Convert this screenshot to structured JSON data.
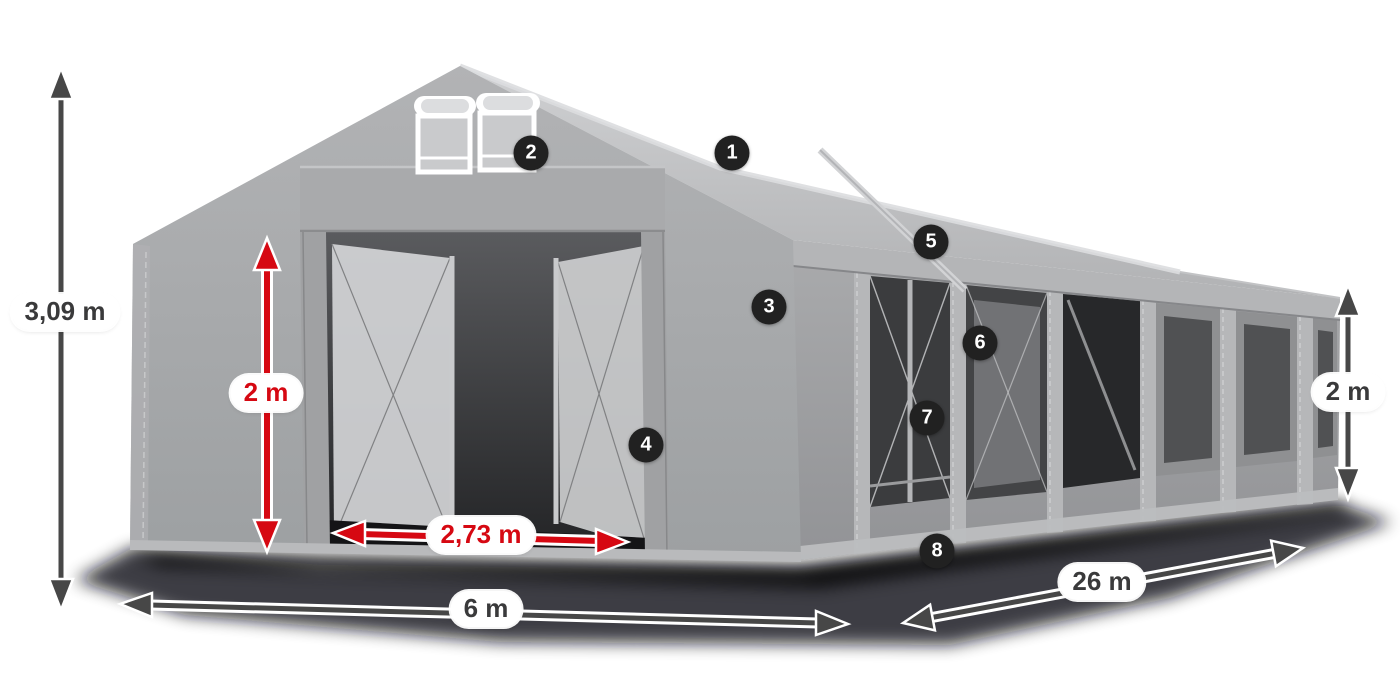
{
  "diagram": {
    "kind": "tent-dimension-diagram"
  },
  "dimensions": {
    "total_height": {
      "label": "3,09 m",
      "color": "#3a3a3b"
    },
    "entrance_height": {
      "label": "2 m",
      "color": "#d60812"
    },
    "entrance_width": {
      "label": "2,73 m",
      "color": "#d60812"
    },
    "width": {
      "label": "6 m",
      "color": "#3a3a3b"
    },
    "length": {
      "label": "26 m",
      "color": "#3a3a3b"
    },
    "side_height": {
      "label": "2 m",
      "color": "#3a3a3b"
    }
  },
  "markers": [
    {
      "number": "1"
    },
    {
      "number": "2"
    },
    {
      "number": "3"
    },
    {
      "number": "4"
    },
    {
      "number": "5"
    },
    {
      "number": "6"
    },
    {
      "number": "7"
    },
    {
      "number": "8"
    }
  ],
  "colors": {
    "background": "#ffffff",
    "accent_red": "#d60812",
    "arrow_dark": "#474747",
    "marker_bg": "#212121",
    "marker_text": "#ffffff",
    "tent_gray": "#a7a8aa",
    "roof_gray": "#c2c3c5",
    "interior_dark": "#3b3c3e"
  }
}
